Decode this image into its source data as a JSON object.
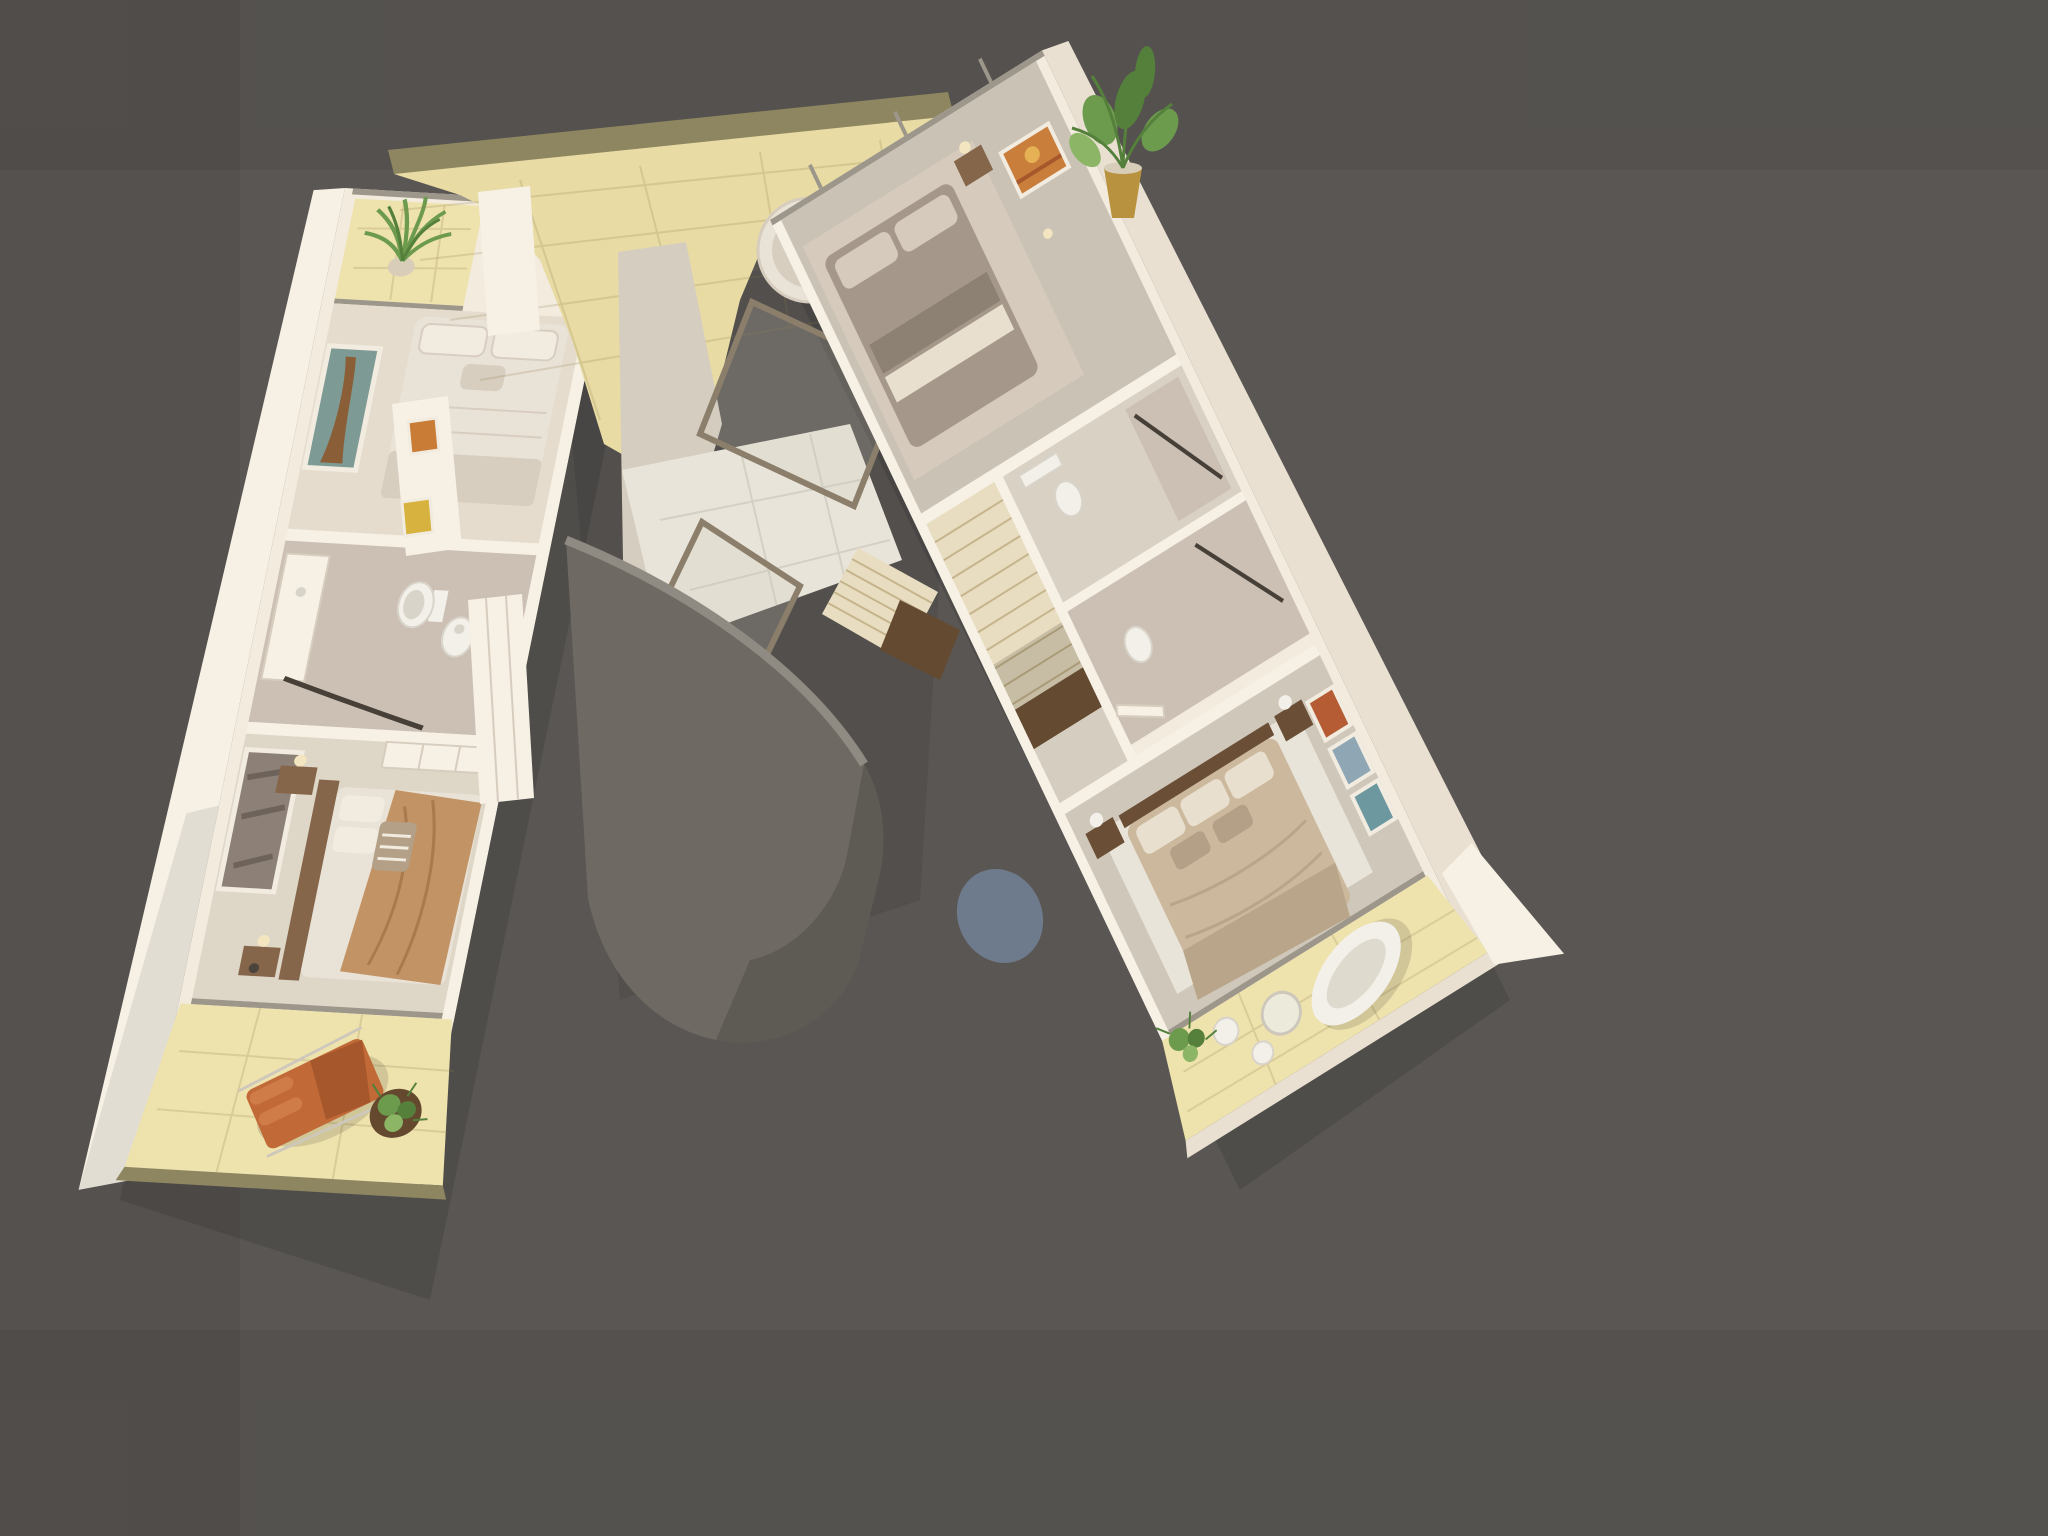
{
  "scene": {
    "type": "architectural-3d-floor-plan-render",
    "view": "top-down-dollhouse",
    "areas": [
      "balcony-top-left",
      "bedroom-front-left",
      "bathroom-left",
      "bedroom-back-left",
      "balcony-bottom-left",
      "roof-terrace",
      "stairwell",
      "landing",
      "curved-wall",
      "bedroom-top-right",
      "corridor-right",
      "bathroom-right-1",
      "bathroom-right-2",
      "bedroom-bottom-right",
      "balcony-bottom-right"
    ],
    "furniture": [
      "double-bed",
      "egg-chair",
      "lounge-chair",
      "freestanding-bathtub",
      "toilet",
      "bidet",
      "vanity",
      "nightstand",
      "wardrobe",
      "wall-art",
      "potted-plant",
      "side-table",
      "stool"
    ]
  },
  "palette": {
    "bg": "#595653",
    "vignette": "rgba(0,0,0,0.05)",
    "shadow1": "rgba(0,0,0,0.10)",
    "shadow2": "rgba(0,0,0,0.08)",
    "softShadow": "rgba(0,0,0,0.12)",
    "wallTop": "#f2ebde",
    "wallBright": "#f6f0e5",
    "wallFace": "#e9e0d1",
    "wallShade": "#d7cdbe",
    "seam": "rgba(130,115,95,0.25)",
    "olive": "#8e8660",
    "terraceFloor": "#e8dba3",
    "balconyFloor": "#eee2ad",
    "grid": "rgba(140,120,70,0.20)",
    "gridCool": "rgba(100,95,80,0.15)",
    "roomFloor1": "#e5dccd",
    "bathFloor": "#cbc0b3",
    "roomFloor2": "#ded6c7",
    "corridorFloor": "#d5cec0",
    "floorA": "#c9c2b5",
    "floorB": "#cfc8ba",
    "bathFloor2": "#d8d1c4",
    "landing": "#e9e4d9",
    "railGray": "#9d968a",
    "frameBrown": "#8b7e6b",
    "glassTint": "rgba(205,200,185,0.22)",
    "bedWhite": "#e9e2d6",
    "pillow": "#f1ebe0",
    "linenShade": "#d8cec0",
    "camel": "#c29465",
    "camelShade": "#a87a4e",
    "accentCushion": "#b3a087",
    "taupe": "#a5988a",
    "taupeDark": "#8d8173",
    "taupeLight": "#d5cabb",
    "sand": "#ccb89d",
    "sandShade": "#b9a589",
    "sandPillow": "#e8dfce",
    "wood": "#85664a",
    "woodDark": "#6a4e36",
    "orange": "#c16a38",
    "orangeDark": "#a6572b",
    "orangeLight": "#cf7c49",
    "chrome": "#cdc7bc",
    "green": "#6d9b4e",
    "greenDark": "#55803c",
    "greenLight": "#8cb665",
    "potGold": "#b8923f",
    "potBeige": "#d8cdb8",
    "potBrown": "#64492f",
    "artTeal": "#7e9a94",
    "artBrown": "#8a5f38",
    "artSepia": "#8d8177",
    "artSepiaDark": "#6e635a",
    "artOrange": "#c97e3c",
    "artSun": "#e6b054",
    "artRed": "#b65c34",
    "artBlue": "#8fa7b5",
    "artTeal2": "#6e98a0",
    "miniYellow": "#d8b23e",
    "miniOrange": "#c87c35",
    "fixtureWhite": "#f3f0ea",
    "fixtureShade": "#d9d4ca",
    "showerGlass": "#474038",
    "curved": "#6e6962",
    "curvedRim": "#8f8a82",
    "curvedShade": "rgba(0,0,0,0.14)",
    "pool": "#6e7b8c",
    "stair": "#e8ddc0",
    "stairLine": "#c6b58c",
    "stairDark": "#654a32",
    "tubInner": "#dedacd",
    "tableTop": "#eceada",
    "lampGlow": "#f2e5bf",
    "darkItem": "#4a443c"
  }
}
